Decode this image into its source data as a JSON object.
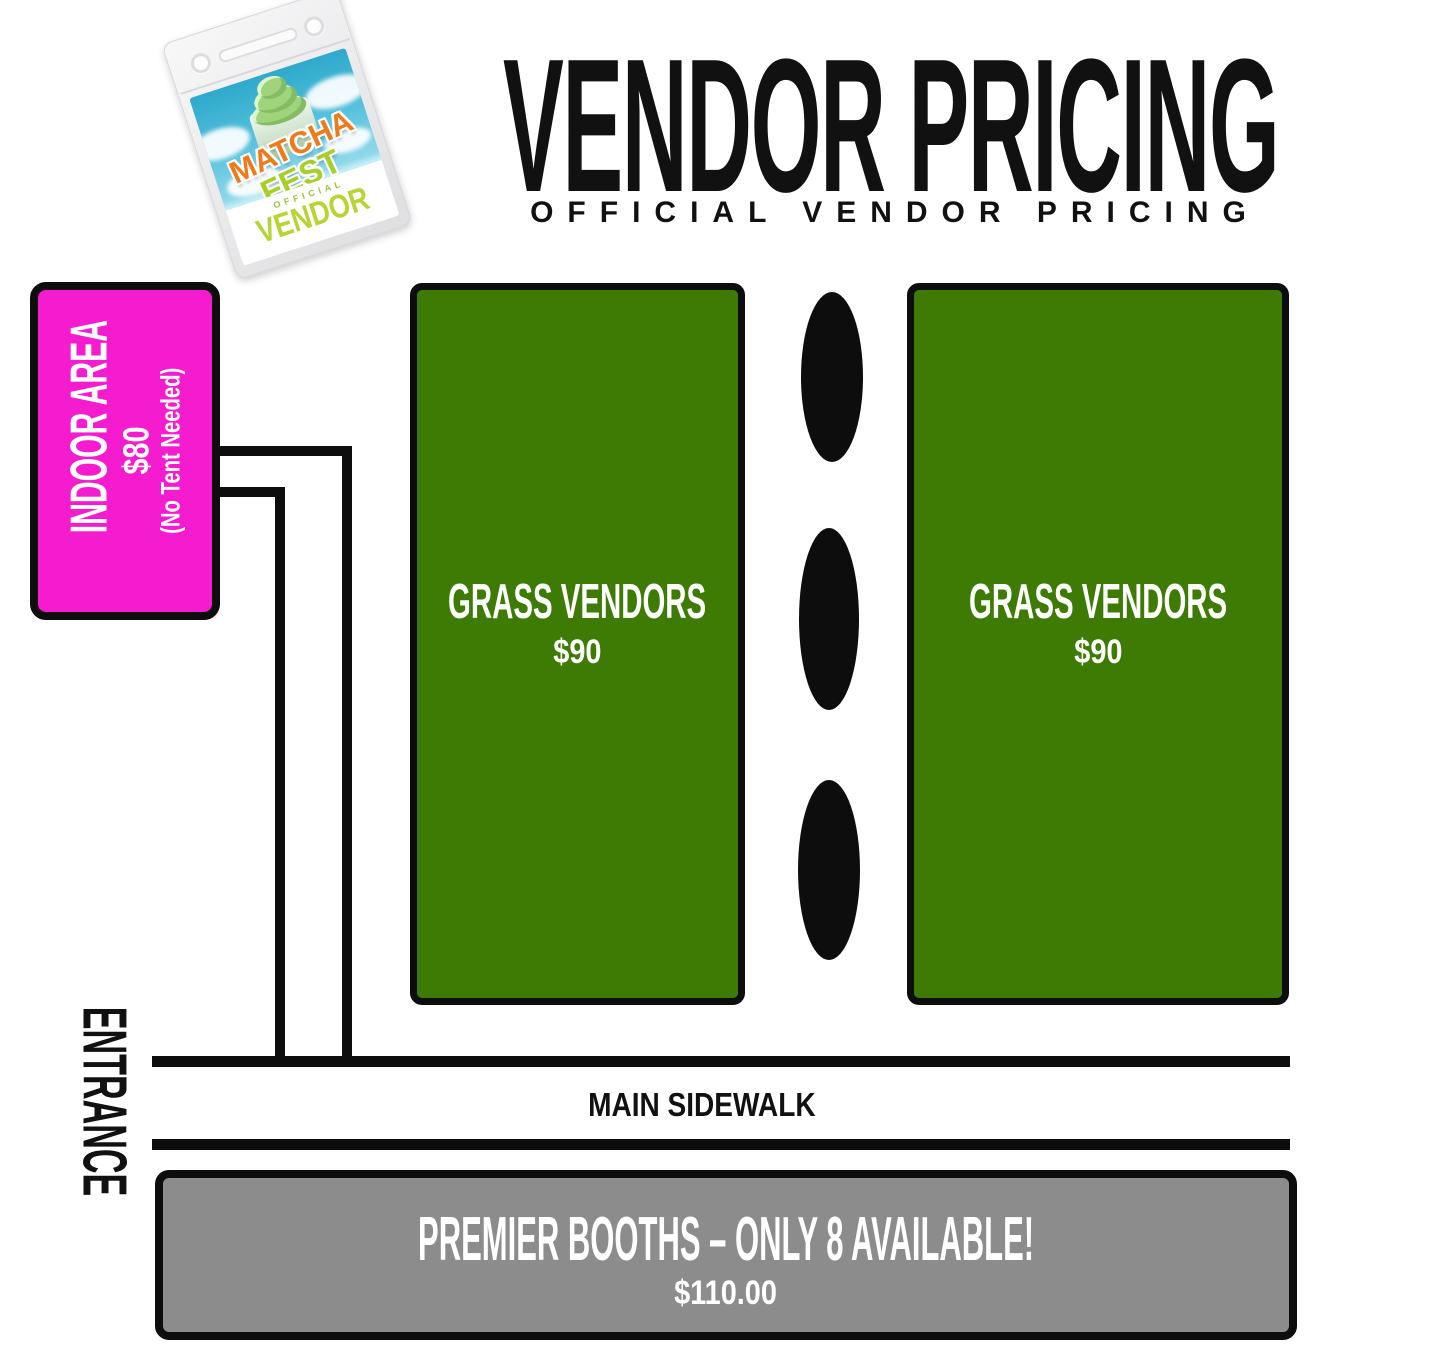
{
  "badge": {
    "event_line1": "MATCHA",
    "event_line2": "FEST",
    "official": "OFFICIAL",
    "vendor": "VENDOR"
  },
  "header": {
    "title": "VENDOR PRICING",
    "subtitle": "OFFICIAL VENDOR PRICING"
  },
  "zones": {
    "indoor": {
      "label": "INDOOR AREA",
      "price": "$80",
      "note": "(No Tent Needed)",
      "color": "#F41CCE"
    },
    "grass_left": {
      "label": "GRASS VENDORS",
      "price": "$90",
      "color": "#3E7B04"
    },
    "grass_right": {
      "label": "GRASS VENDORS",
      "price": "$90",
      "color": "#3E7B04"
    },
    "premier": {
      "label": "PREMIER BOOTHS – ONLY 8 AVAILABLE!",
      "price": "$110.00",
      "color": "#8C8C8C"
    }
  },
  "labels": {
    "entrance": "ENTRANCE",
    "main_sidewalk": "MAIN SIDEWALK"
  },
  "decor": {
    "tree_marker_count": 3
  }
}
